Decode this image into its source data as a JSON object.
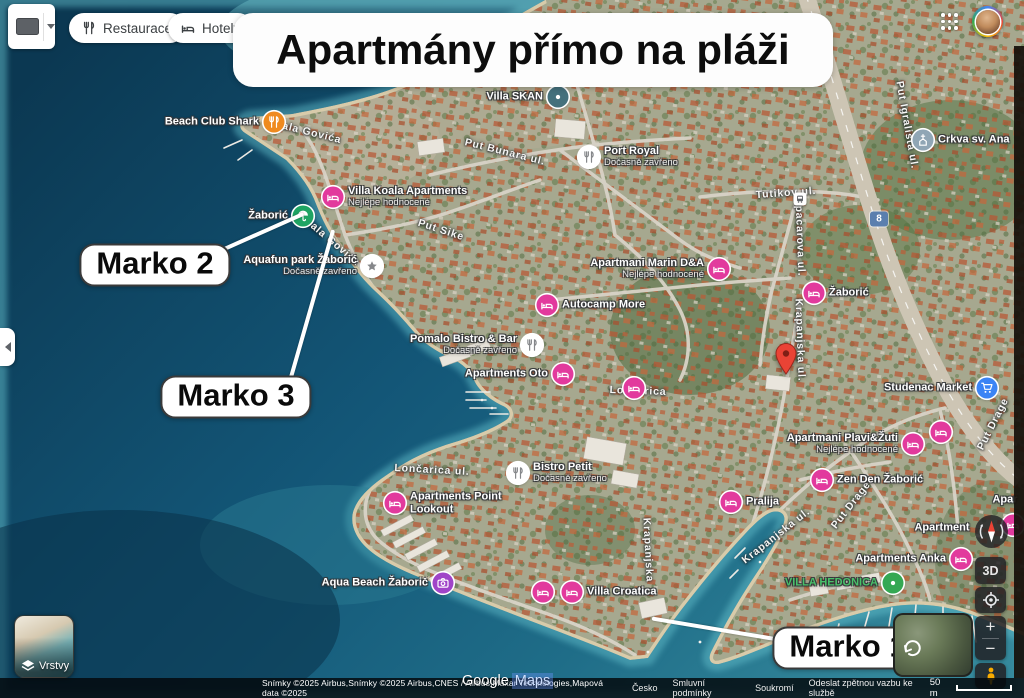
{
  "topbar": {
    "widget_tooltip": "input selector",
    "filter_chips": [
      {
        "label": "Restaurace",
        "icon": "restaurant-icon"
      },
      {
        "label": "Hotely",
        "icon": "hotel-icon"
      }
    ],
    "banner_title": "Apartmány přímo na pláži"
  },
  "map": {
    "pois": [
      {
        "name": "Beach Club Shark",
        "icon": "restaurant-icon",
        "color": "#ef8a1f",
        "x": 274,
        "y": 122,
        "side": "left"
      },
      {
        "name": "Villa SKAN",
        "icon": "dot-icon",
        "color": "#44707c",
        "x": 558,
        "y": 97,
        "side": "left"
      },
      {
        "name": "Port Royal",
        "sub": "Dočasně zavřeno",
        "icon": "restaurant-icon",
        "color": "#ffffff",
        "x": 589,
        "y": 157,
        "side": "right"
      },
      {
        "name": "Crkva sv. Ana",
        "icon": "church-icon",
        "color": "#90a6b5",
        "x": 923,
        "y": 140,
        "side": "right"
      },
      {
        "name": "Villa Koala Apartments",
        "sub": "Nejlépe hodnocené",
        "icon": "bed-icon",
        "color": "#e23a9d",
        "x": 333,
        "y": 197,
        "side": "right"
      },
      {
        "name": "Žaborić",
        "icon": "umbrella-icon",
        "color": "#1fa463",
        "x": 303,
        "y": 216,
        "side": "left"
      },
      {
        "name": "Aquafun park Žaborić",
        "sub": "Dočasně zavřeno",
        "icon": "star-icon",
        "color": "#ffffff",
        "x": 372,
        "y": 266,
        "side": "left"
      },
      {
        "name": "Apartmani Marin D&A",
        "sub": "Nejlépe hodnocené",
        "icon": "bed-icon",
        "color": "#e23a9d",
        "x": 719,
        "y": 269,
        "side": "left"
      },
      {
        "name": "Autocamp More",
        "icon": "bed-icon",
        "color": "#e23a9d",
        "x": 547,
        "y": 305,
        "side": "right"
      },
      {
        "name": "Žaborić",
        "icon": "bed-icon",
        "color": "#e23a9d",
        "x": 814,
        "y": 293,
        "side": "right"
      },
      {
        "name": "Pomalo Bistro & Bar",
        "sub": "Dočasně zavřeno",
        "icon": "restaurant-icon",
        "color": "#ffffff",
        "x": 532,
        "y": 345,
        "side": "left"
      },
      {
        "name": "Apartments Oto",
        "icon": "bed-icon",
        "color": "#e23a9d",
        "x": 563,
        "y": 374,
        "side": "left"
      },
      {
        "name": "",
        "icon": "bed-icon",
        "color": "#e23a9d",
        "x": 634,
        "y": 388,
        "side": "right"
      },
      {
        "name": "Bistro Petit",
        "sub": "Dočasně zavřeno",
        "icon": "restaurant-icon",
        "color": "#ffffff",
        "x": 518,
        "y": 473,
        "side": "right"
      },
      {
        "name": "Apartments Point Lookout",
        "icon": "bed-icon",
        "color": "#e23a9d",
        "x": 395,
        "y": 503,
        "side": "right",
        "wrap": true
      },
      {
        "name": "Aqua Beach Žaborič",
        "icon": "camera-icon",
        "color": "#a044c8",
        "x": 443,
        "y": 583,
        "side": "left"
      },
      {
        "name": "",
        "icon": "bed-icon",
        "color": "#e23a9d",
        "x": 543,
        "y": 592,
        "side": "right"
      },
      {
        "name": "Villa Croatica",
        "icon": "bed-icon",
        "color": "#e23a9d",
        "x": 572,
        "y": 592,
        "side": "right"
      },
      {
        "name": "Apartmani Plavi&Žuti",
        "sub": "Nejlépe hodnocené",
        "icon": "bed-icon",
        "color": "#e23a9d",
        "x": 913,
        "y": 444,
        "side": "left"
      },
      {
        "name": "",
        "icon": "bed-icon",
        "color": "#e23a9d",
        "x": 941,
        "y": 432,
        "side": "right"
      },
      {
        "name": "Zen Den Žaborić",
        "icon": "bed-icon",
        "color": "#e23a9d",
        "x": 822,
        "y": 480,
        "side": "right"
      },
      {
        "name": "Pralija",
        "icon": "bed-icon",
        "color": "#e23a9d",
        "x": 731,
        "y": 502,
        "side": "right"
      },
      {
        "name": "Apartments Anka",
        "icon": "bed-icon",
        "color": "#e23a9d",
        "x": 961,
        "y": 559,
        "side": "left"
      },
      {
        "name": "Apartment",
        "icon": null,
        "x": 942,
        "y": 528
      },
      {
        "name": "Apar",
        "icon": null,
        "x": 1005,
        "y": 500
      },
      {
        "name": "VILLA HEDONICA",
        "icon": "dot-icon",
        "color": "#34a853",
        "x": 893,
        "y": 583,
        "side": "left",
        "text_color": "#49c06a"
      },
      {
        "name": "Studenac Market",
        "icon": "cart-icon",
        "color": "#3b84f5",
        "x": 987,
        "y": 388,
        "side": "left"
      },
      {
        "name": "",
        "icon": "bed-icon",
        "color": "#e23a9d",
        "x": 1013,
        "y": 525,
        "side": "right"
      }
    ],
    "street_labels": [
      {
        "text": "Obala Govića",
        "x": 304,
        "y": 131,
        "r": 14
      },
      {
        "text": "Put Bunara ul.",
        "x": 505,
        "y": 152,
        "r": 14
      },
      {
        "text": "Put Sike",
        "x": 441,
        "y": 230,
        "r": 18
      },
      {
        "text": "Obala Govića",
        "x": 329,
        "y": 239,
        "r": 40
      },
      {
        "text": "Tutikov ul.",
        "x": 786,
        "y": 193,
        "r": -4
      },
      {
        "text": "Spacarova ul.",
        "x": 800,
        "y": 237,
        "r": 88
      },
      {
        "text": "Put Igrališta ul.",
        "x": 907,
        "y": 125,
        "r": 80
      },
      {
        "text": "Krapanjska ul.",
        "x": 800,
        "y": 340,
        "r": 88
      },
      {
        "text": "Lončarica",
        "x": 638,
        "y": 391,
        "r": 2
      },
      {
        "text": "Lončarica ul.",
        "x": 432,
        "y": 470,
        "r": 3
      },
      {
        "text": "Krapanjska",
        "x": 648,
        "y": 550,
        "r": 87
      },
      {
        "text": "Krapanjska ul.",
        "x": 776,
        "y": 536,
        "r": -38
      },
      {
        "text": "Put Drage",
        "x": 851,
        "y": 505,
        "r": -52
      },
      {
        "text": "Put Drage",
        "x": 993,
        "y": 424,
        "r": -63
      }
    ],
    "markers": [
      {
        "type": "red-pin",
        "x": 786,
        "y": 380
      },
      {
        "type": "route-shield",
        "text": "8",
        "x": 879,
        "y": 219
      },
      {
        "type": "bus-stop",
        "x": 800,
        "y": 199
      }
    ],
    "callouts": [
      {
        "label": "Marko 2",
        "box": {
          "x": 155,
          "y": 265
        },
        "line": {
          "x1": 222,
          "y1": 250,
          "x2": 303,
          "y2": 214
        }
      },
      {
        "label": "Marko 3",
        "box": {
          "x": 236,
          "y": 397
        },
        "line": {
          "x1": 290,
          "y1": 380,
          "x2": 333,
          "y2": 230
        }
      },
      {
        "label": "Marko 1",
        "box": {
          "x": 848,
          "y": 648
        },
        "line": {
          "x1": 790,
          "y1": 642,
          "x2": 652,
          "y2": 619
        }
      }
    ]
  },
  "controls": {
    "layers_label": "Vrstvy",
    "btn_3d_label": "3D",
    "zoom_in_label": "+",
    "zoom_out_label": "−"
  },
  "footer": {
    "watermark_google": "Google",
    "watermark_maps": "Maps",
    "attribution": "Snímky ©2025 Airbus,Snímky ©2025 Airbus,CNES / Airbus,Maxar Technologies,Mapová data ©2025",
    "links": [
      "Česko",
      "Smluvní podmínky",
      "Soukromí",
      "Odeslat zpětnou vazbu ke službě"
    ],
    "scale_label": "50 m"
  },
  "theme": {
    "poi_pink": "#e23a9d",
    "poi_green": "#1fa463",
    "poi_blue": "#3b84f5",
    "poi_orange": "#ef8a1f",
    "pin_red": "#ea4335",
    "sea_deep": "#0b3852",
    "sea_shore": "#35899c"
  }
}
